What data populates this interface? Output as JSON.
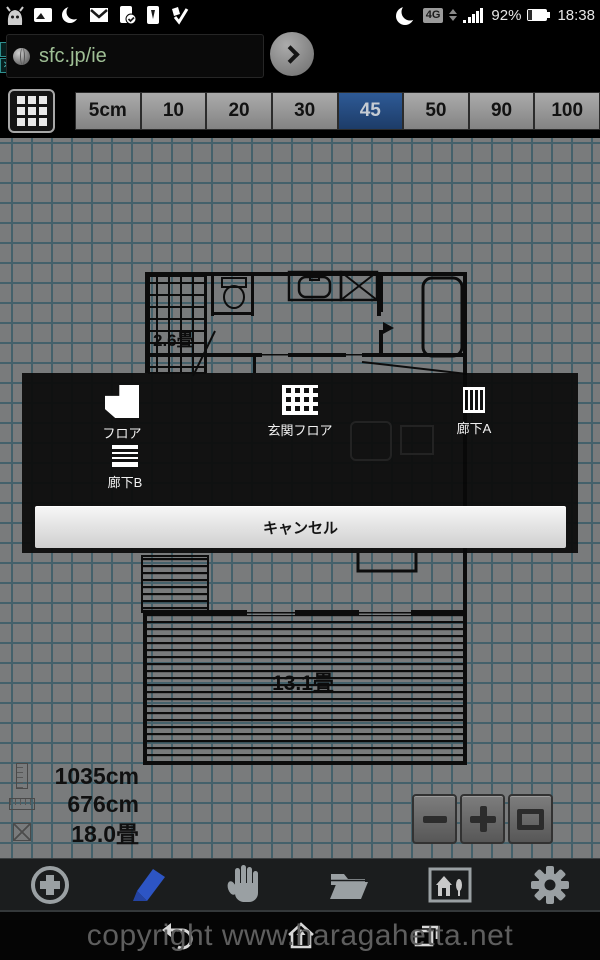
{
  "status_bar": {
    "time": "18:38",
    "battery": "92%",
    "network_badge": "4G",
    "left_icon_names": [
      "app-robot-icon",
      "gallery-icon",
      "moon-icon",
      "gmail-icon",
      "tablet-check-icon",
      "phone-icon",
      "tasks-check-icon"
    ],
    "right_icon_names": [
      "moon-icon",
      "network-4g-badge",
      "data-arrows-icon",
      "signal-bars-icon",
      "battery-icon"
    ]
  },
  "address_bar": {
    "url": "sfc.jp/ie",
    "info_glyph": "i",
    "close_glyph": "✕"
  },
  "scale_toolbar": {
    "buttons": [
      "5cm",
      "10",
      "20",
      "30",
      "45",
      "50",
      "90",
      "100"
    ],
    "selected": "45"
  },
  "floor_plan": {
    "labels": {
      "stair_room": "2.6畳",
      "living_room": "13.1畳"
    }
  },
  "dialog": {
    "items": [
      {
        "label": "フロア",
        "icon": "floor-icon"
      },
      {
        "label": "玄関フロア",
        "icon": "entrance-floor-icon"
      },
      {
        "label": "廊下A",
        "icon": "corridor-a-icon"
      },
      {
        "label": "廊下B",
        "icon": "corridor-b-icon"
      }
    ],
    "cancel": "キャンセル"
  },
  "measurements": {
    "height": "1035cm",
    "width": "676cm",
    "area": "18.0畳"
  },
  "watermark": "copyright www.haragahetta.net",
  "colors": {
    "selected_button_blue": "#27497b",
    "url_green": "#9fbf95",
    "pen_blue": "#2d55c4",
    "canvas_bg": "#797b7c",
    "grid_line": "#44616b",
    "dialog_bg": "#0d0d0d"
  }
}
